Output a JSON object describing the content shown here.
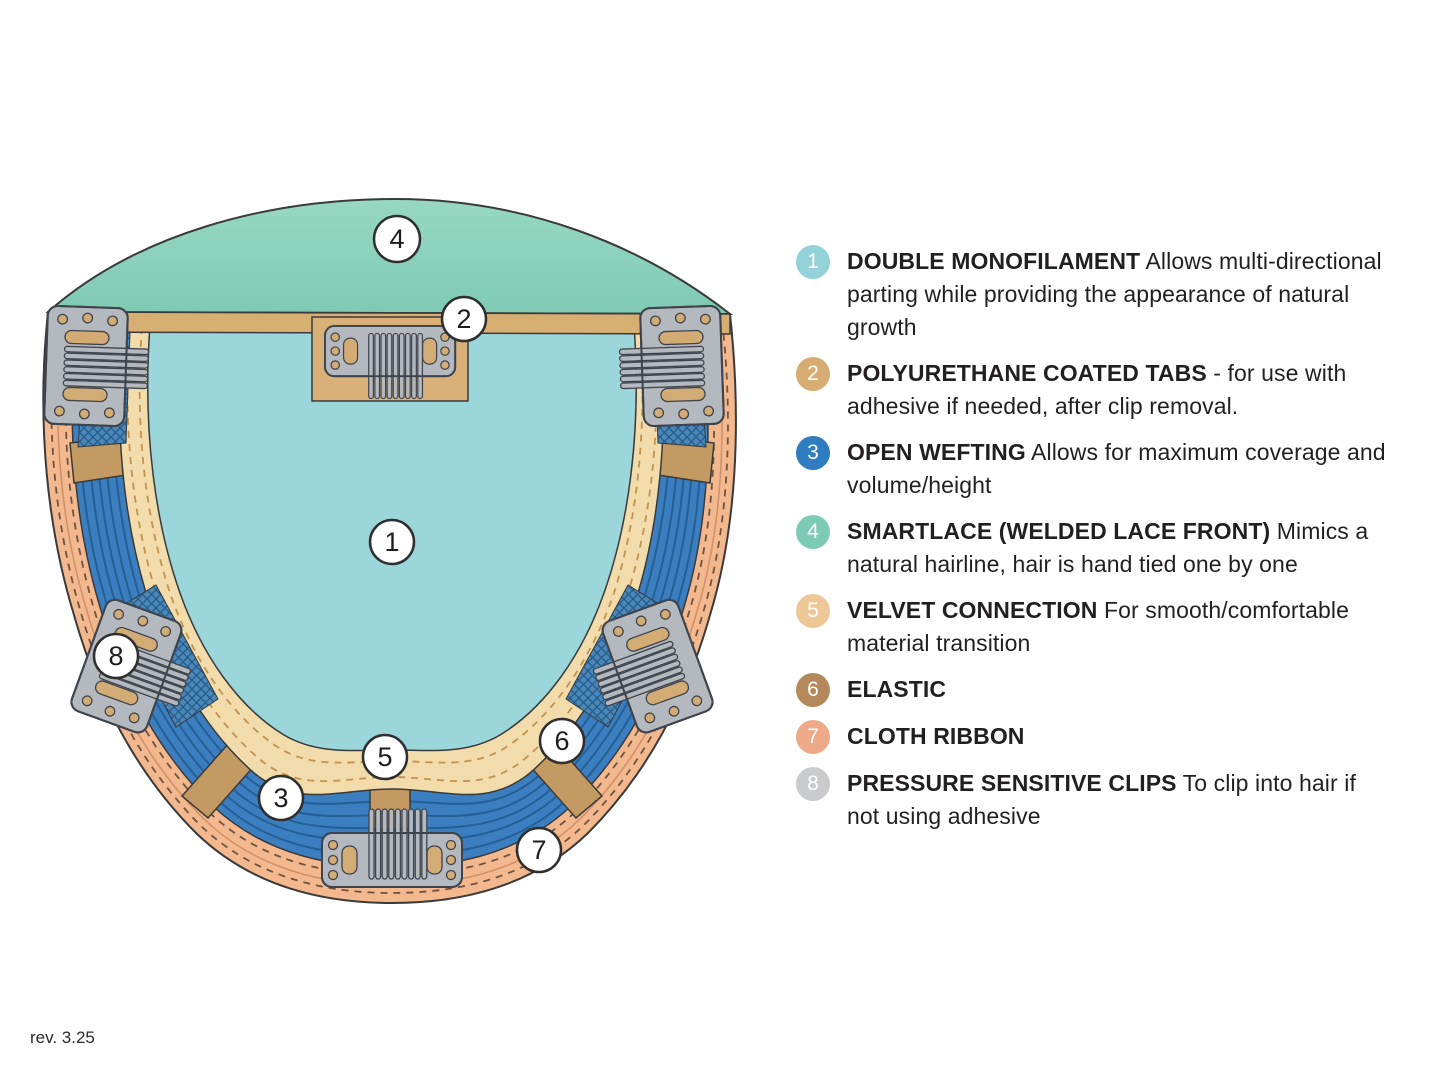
{
  "page": {
    "background_color": "#ffffff",
    "revision": "rev. 3.25"
  },
  "diagram": {
    "callout_numbers": [
      "1",
      "2",
      "3",
      "4",
      "5",
      "6",
      "7",
      "8"
    ],
    "colors": {
      "lace_front_top": "#97d8c2",
      "lace_front_bottom": "#7fcab4",
      "monofilament": "#9bd6db",
      "open_wefting": "#3b7fc0",
      "weft_line": "#255f94",
      "velvet_band": "#f2dcab",
      "cloth_ribbon": "#f3b88d",
      "tab_band": "#d8af72",
      "elastic": "#c49a63",
      "clip_metal": "#b4b8bf",
      "mesh": "#4b87b7",
      "outline": "#3a3a3a"
    }
  },
  "legend": {
    "items": [
      {
        "number": "1",
        "badge_color": "#92d2d8",
        "title": "DOUBLE MONOFILAMENT",
        "description": "Allows multi-directional parting while providing the appearance of natural growth"
      },
      {
        "number": "2",
        "badge_color": "#d6ac72",
        "title": "POLYURETHANE COATED TABS",
        "description": "- for use with adhesive if needed, after clip removal."
      },
      {
        "number": "3",
        "badge_color": "#2f7cc0",
        "title": "OPEN WEFTING",
        "description": "Allows for maximum coverage and volume/height"
      },
      {
        "number": "4",
        "badge_color": "#7dcbb4",
        "title": "SMARTLACE (WELDED LACE FRONT)",
        "description": "Mimics a natural hairline, hair is hand tied one by one"
      },
      {
        "number": "5",
        "badge_color": "#edc795",
        "title": "VELVET CONNECTION",
        "description": "For smooth/comfortable material transition"
      },
      {
        "number": "6",
        "badge_color": "#b3885a",
        "title": "ELASTIC",
        "description": ""
      },
      {
        "number": "7",
        "badge_color": "#eda988",
        "title": "CLOTH RIBBON",
        "description": ""
      },
      {
        "number": "8",
        "badge_color": "#c9cbcd",
        "title": "PRESSURE SENSITIVE CLIPS",
        "description": "To clip into hair if not using adhesive"
      }
    ]
  }
}
